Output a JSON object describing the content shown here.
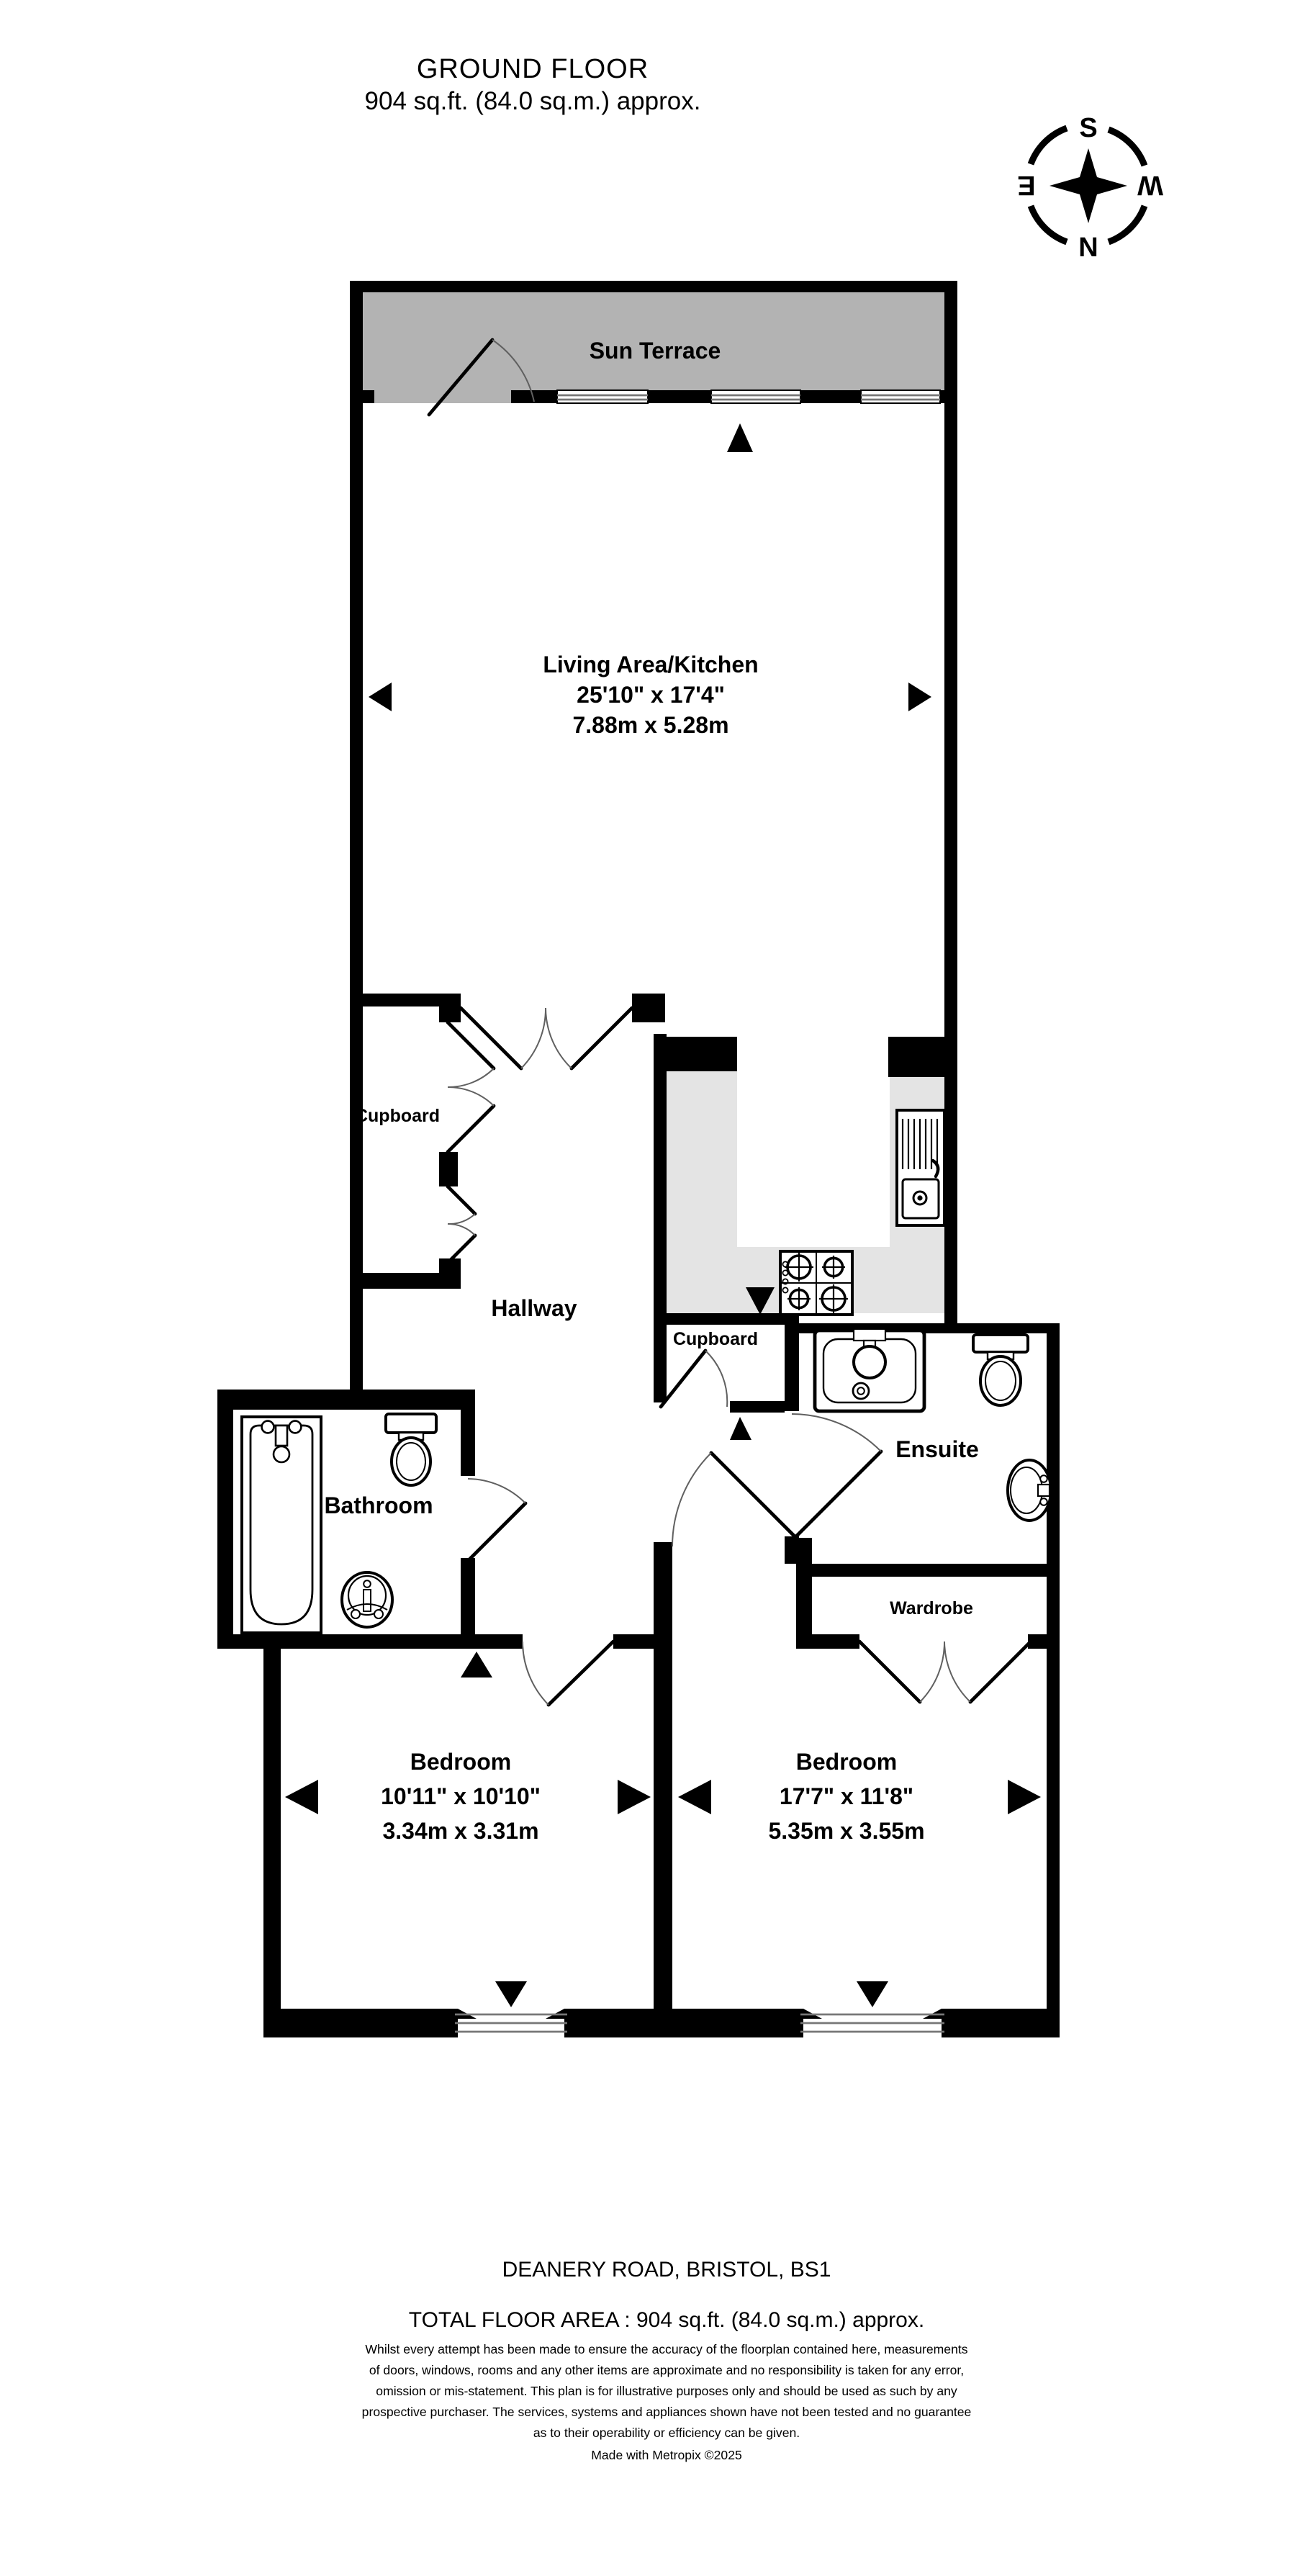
{
  "title": {
    "line1": "GROUND FLOOR",
    "line2": "904 sq.ft. (84.0 sq.m.) approx."
  },
  "compass": {
    "n": "N",
    "s": "S",
    "e": "E",
    "w": "W"
  },
  "rooms": {
    "sun_terrace": {
      "name": "Sun Terrace"
    },
    "living": {
      "name": "Living Area/Kitchen",
      "dims_imperial": "25'10\"  x 17'4\"",
      "dims_metric": "7.88m  x 5.28m"
    },
    "hallway": {
      "name": "Hallway"
    },
    "cupboard_left": {
      "name": "Cupboard"
    },
    "cupboard_middle": {
      "name": "Cupboard"
    },
    "ensuite": {
      "name": "Ensuite"
    },
    "bathroom": {
      "name": "Bathroom"
    },
    "wardrobe": {
      "name": "Wardrobe"
    },
    "bedroom_left": {
      "name": "Bedroom",
      "dims_imperial": "10'11\"  x 10'10\"",
      "dims_metric": "3.34m  x 3.31m"
    },
    "bedroom_right": {
      "name": "Bedroom",
      "dims_imperial": "17'7\"  x 11'8\"",
      "dims_metric": "5.35m  x 3.55m"
    }
  },
  "footer": {
    "address": "DEANERY ROAD, BRISTOL, BS1",
    "total_area": "TOTAL FLOOR AREA : 904 sq.ft. (84.0 sq.m.) approx.",
    "disclaimer": [
      "Whilst every attempt has been made to ensure the accuracy of the floorplan contained here, measurements",
      "of doors, windows, rooms and any other items are approximate and no responsibility is taken for any error,",
      "omission or mis-statement. This plan is for illustrative purposes only and should be used as such by any",
      "prospective purchaser. The services, systems and appliances shown have not been tested and no guarantee",
      "as to their operability or efficiency can be given."
    ],
    "credit": "Made with Metropix ©2025"
  },
  "colors": {
    "wall": "#000000",
    "terrace_fill": "#b3b3b3",
    "kitchen_fill": "#e4e4e4"
  }
}
